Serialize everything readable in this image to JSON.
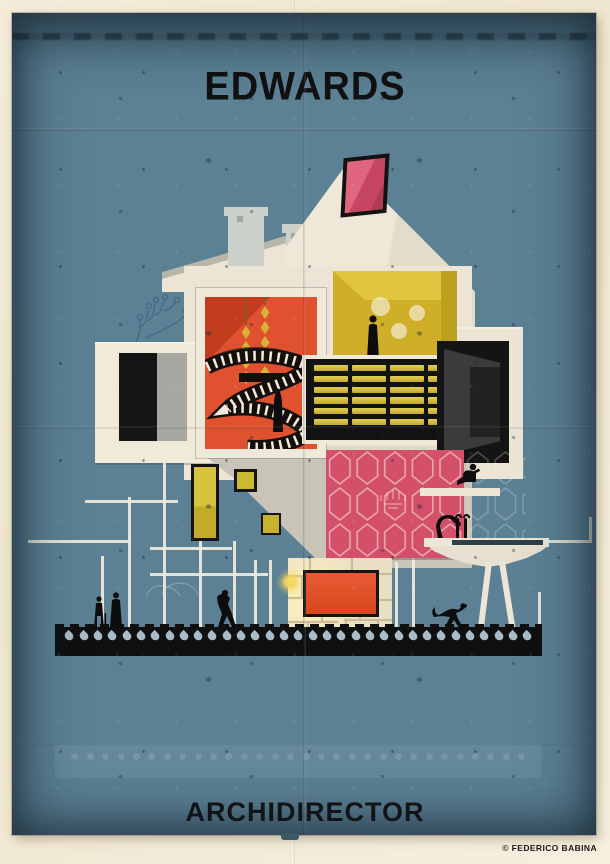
{
  "poster": {
    "title": "EDWARDS",
    "series_title": "ARCHIDIRECTOR",
    "credit": "© FEDERICO BABINA"
  },
  "palette": {
    "poster_blue": "#5c8094",
    "poster_blue_dark": "#3c5766",
    "paper_cream": "#f2ead8",
    "house_cream": "#ece5d5",
    "chimney_gray": "#ccd1ca",
    "skylight_pink": "#d5506b",
    "orange_room": "#e05130",
    "orange_room_dark": "#c13d1e",
    "gold": "#d9b232",
    "yellow_room": "#d3b22a",
    "grid_pane": "#d1b942",
    "pink_room": "#d4506a",
    "red_screen": "#dd4f2c",
    "stone_wall": "#e9dfc5",
    "drop_blue": "#a7bcc6",
    "figure_black": "#0d0d0d"
  },
  "ground": {
    "droplet_count": 33
  },
  "echo_band": {
    "dot_count": 30
  },
  "grid_window": {
    "cols": 4,
    "rows": 6
  },
  "orange_room": {
    "lamp_chains": [
      {
        "count": 4
      },
      {
        "count": 5
      }
    ]
  },
  "yellow_room": {
    "light_count": 3
  }
}
